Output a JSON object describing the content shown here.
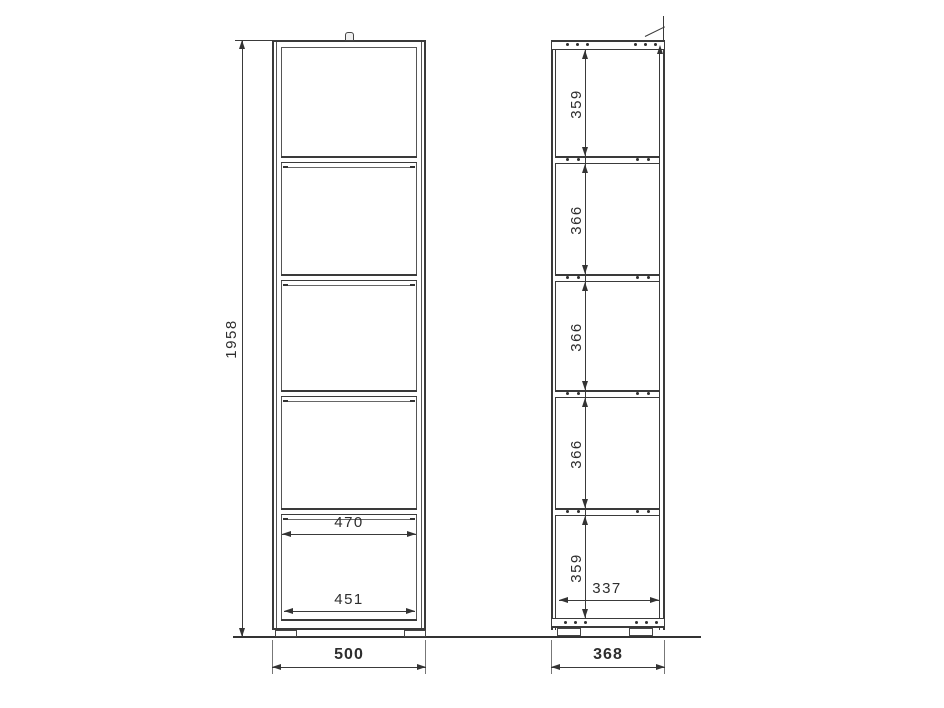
{
  "drawing": {
    "kind": "shelf-unit-technical-drawing",
    "views": 2
  },
  "dims": {
    "front": {
      "overall_height": "1958",
      "shelf_inner_width": "470",
      "bottom_inner_width": "451",
      "overall_width": "500"
    },
    "side": {
      "compartments": [
        "359",
        "366",
        "366",
        "366",
        "359"
      ],
      "inner_depth": "337",
      "overall_depth": "368"
    }
  },
  "colors": {
    "line": "#3a3a3a",
    "text": "#2e2e2e",
    "background": "#ffffff"
  }
}
